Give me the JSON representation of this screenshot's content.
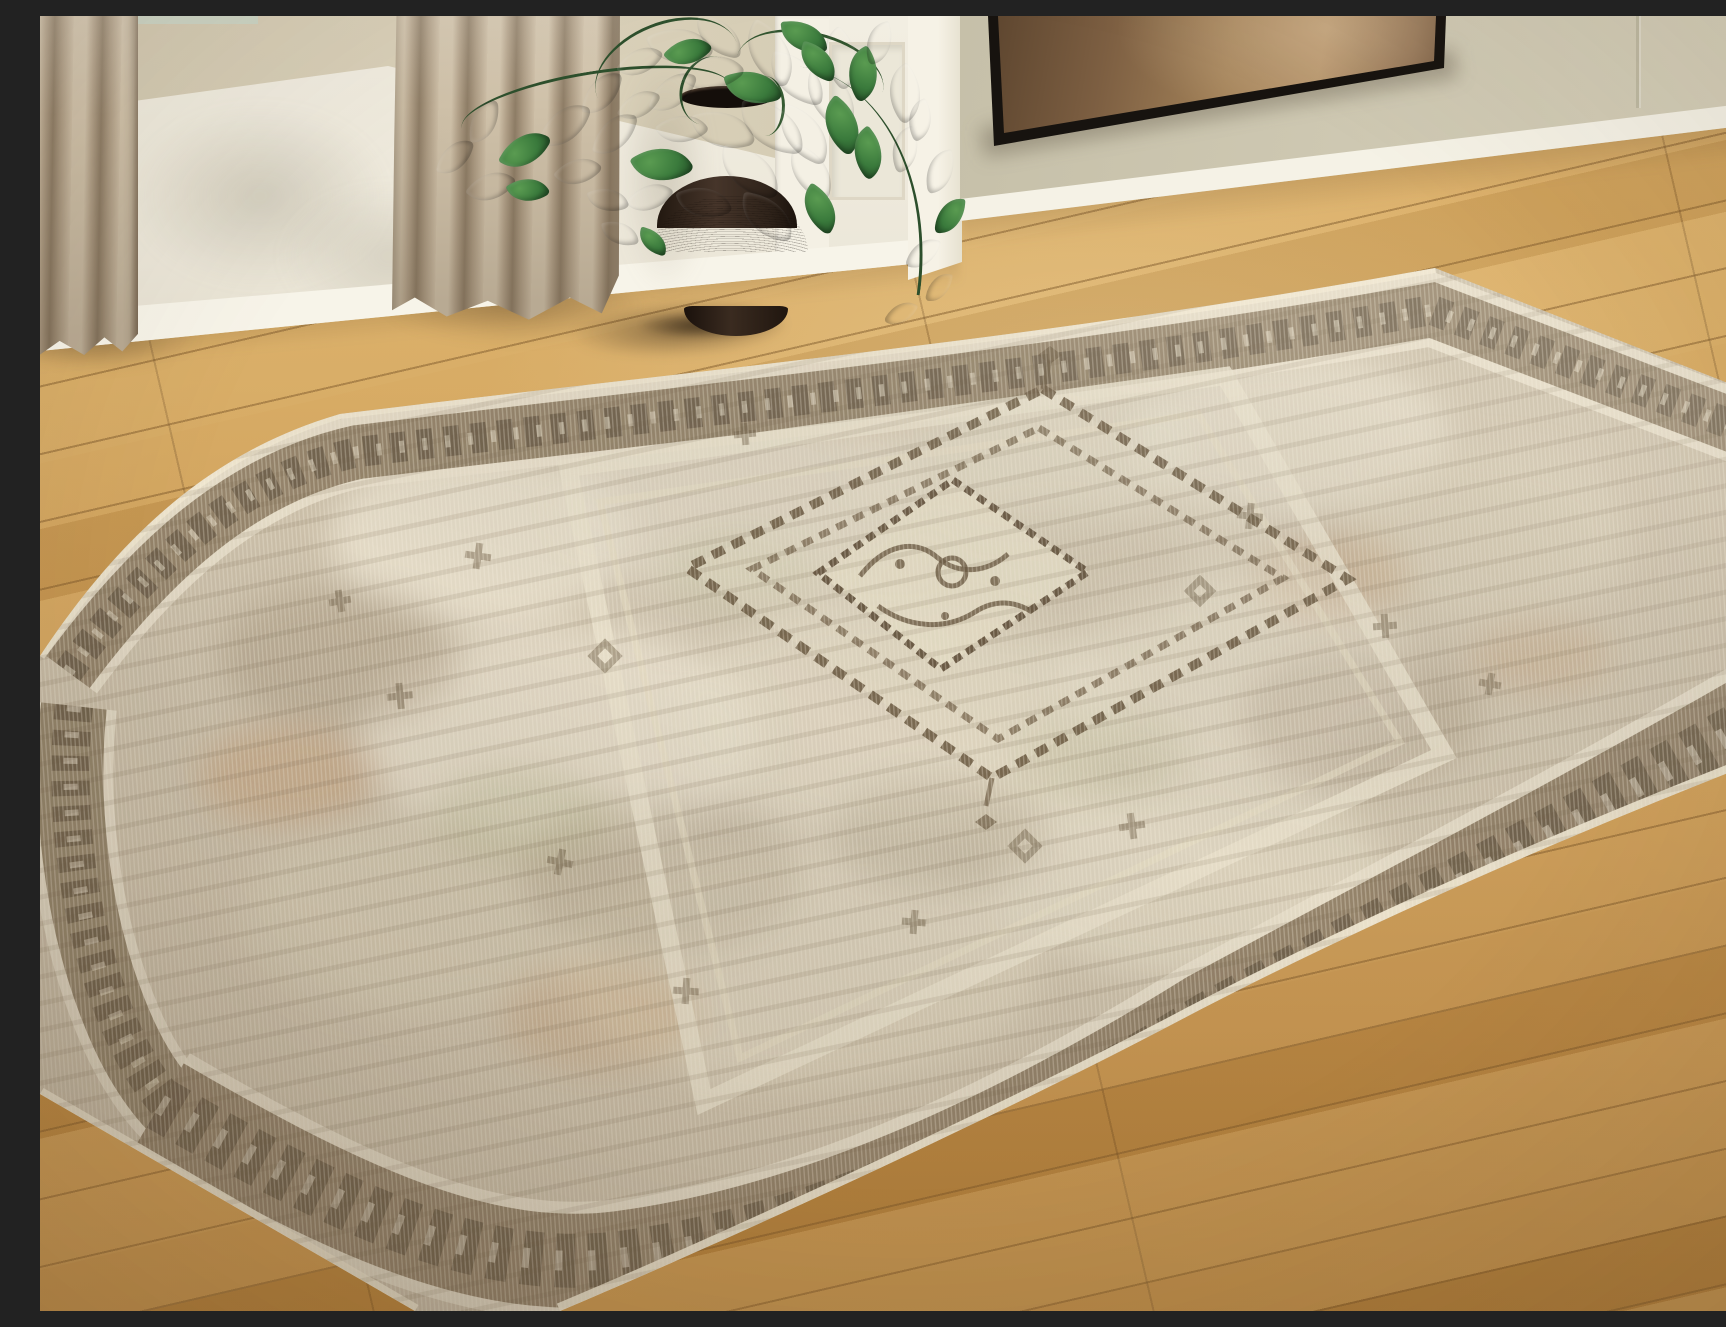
{
  "meta": {
    "type": "photograph",
    "caption": "Living room scene: a distressed vintage-style medallion area rug in beige, cream, taupe and brown lies diagonally on light oak plank flooring. Behind it are a white wainscoted wall with a beige upper band, beige linen curtains, a dark brown gourd-shaped vase holding a leafy green philodendron, a white column, and a sage wall with a bronze abstract painting in a thin black frame."
  },
  "scene": {
    "objects": [
      {
        "id": "area-rug",
        "label": "Distressed vintage medallion area rug"
      },
      {
        "id": "wood-floor",
        "label": "Light oak plank wood floor"
      },
      {
        "id": "framed-artwork",
        "label": "Bronze abstract painting in black frame"
      },
      {
        "id": "vase",
        "label": "Dark brown gourd-shaped ceramic vase"
      },
      {
        "id": "plant",
        "label": "Green philodendron foliage"
      },
      {
        "id": "curtain-main",
        "label": "Beige linen curtain panel"
      },
      {
        "id": "curtain-left",
        "label": "Beige linen curtain panel (edge)"
      },
      {
        "id": "wall-left",
        "label": "White wainscot wall with beige band"
      },
      {
        "id": "wall-right",
        "label": "Sage green wall with white baseboard"
      },
      {
        "id": "pillar",
        "label": "White column"
      }
    ]
  },
  "palette": {
    "floor_light": "#d9ac63",
    "floor_dark": "#b2833f",
    "rug_field": "#cbbfa9",
    "rug_cream": "#e9e1cd",
    "rug_border": "#8d7c63",
    "rug_dark_motif": "#5a4b39",
    "rug_rust": "#bf8757",
    "rug_green": "#9aa06e",
    "wall_white": "#f0ece0",
    "wall_sage": "#cac4ad",
    "wall_band": "#d7ceb7",
    "curtain": "#b7a68e",
    "vase": "#3b2d23",
    "leaf": "#2f5c33",
    "art_bronze": "#a28158",
    "art_frame": "#17130f"
  }
}
